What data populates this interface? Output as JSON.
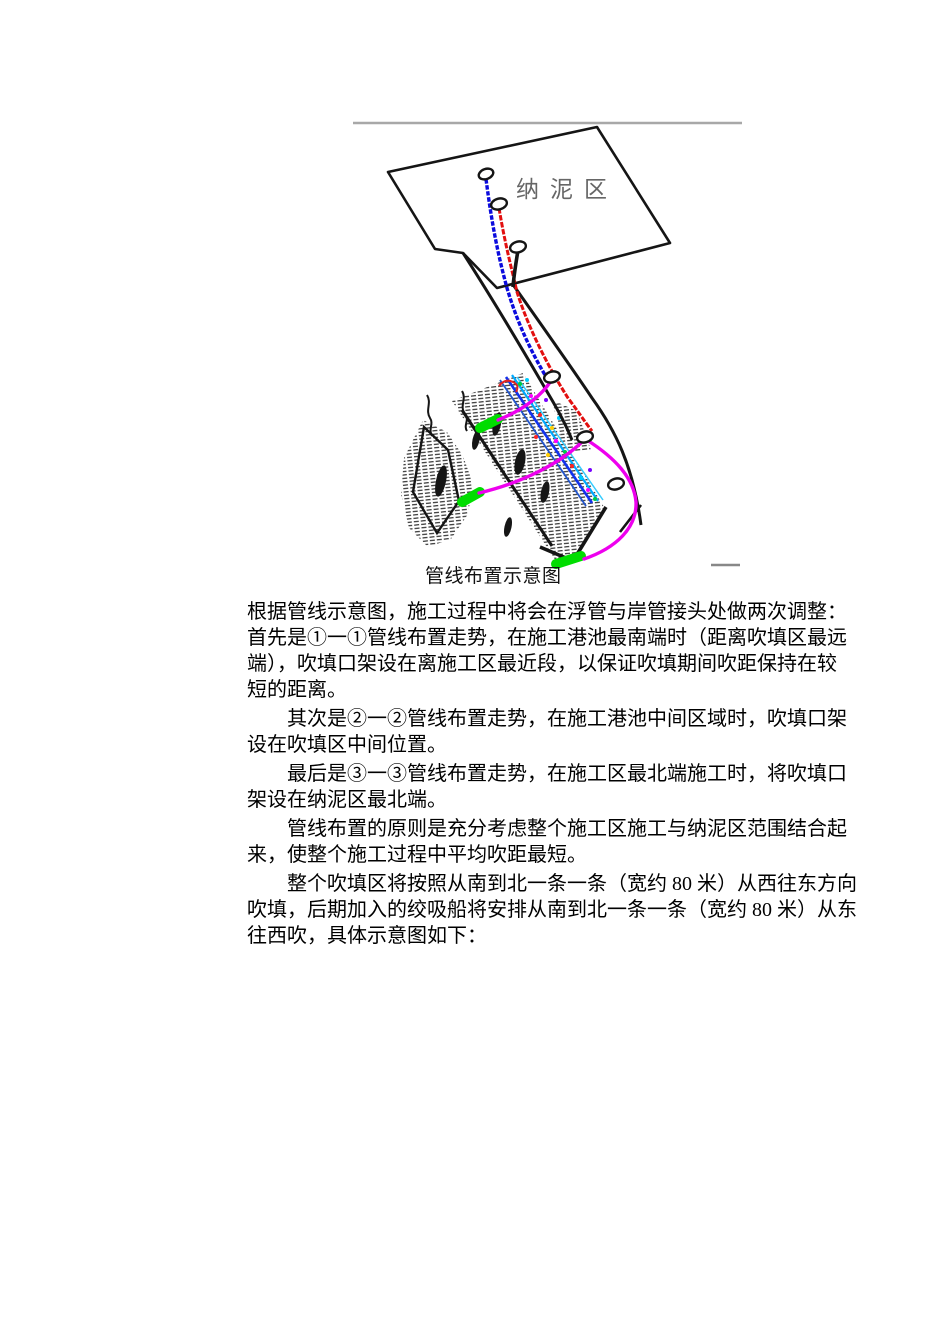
{
  "figure": {
    "region_label": "纳泥区",
    "caption": "管线布置示意图",
    "colors": {
      "ink": "#151515",
      "rule_gray": "#a8a8a8",
      "dash_gray": "#888888",
      "label_gray": "#666666",
      "pipe_blue": "#0b0bdd",
      "pipe_red": "#e20f0f",
      "arc_magenta": "#ee00ee",
      "marker_green": "#00dd00",
      "cluster_blue": "#1133ee",
      "cluster_cyan": "#00aaff",
      "cluster_light": "#33ccff"
    }
  },
  "body": {
    "paragraphs": [
      {
        "indent": false,
        "lines": [
          "根据管线示意图，施工过程中将会在浮管与岸管接头处做两次调整：",
          "首先是①一①管线布置走势，在施工港池最南端时（距离吹填区最远",
          "端），吹填口架设在离施工区最近段，以保证吹填期间吹距保持在较",
          "短的距离。"
        ]
      },
      {
        "indent": true,
        "lines": [
          "其次是②一②管线布置走势，在施工港池中间区域时，吹填口架",
          "设在吹填区中间位置。"
        ]
      },
      {
        "indent": true,
        "lines": [
          "最后是③一③管线布置走势，在施工区最北端施工时，将吹填口",
          "架设在纳泥区最北端。"
        ]
      },
      {
        "indent": true,
        "lines": [
          "管线布置的原则是充分考虑整个施工区施工与纳泥区范围结合起",
          "来，使整个施工过程中平均吹距最短。"
        ]
      },
      {
        "indent": true,
        "lines": [
          "整个吹填区将按照从南到北一条一条（宽约 80 米）从西往东方向",
          "吹填，后期加入的绞吸船将安排从南到北一条一条（宽约 80 米）从东",
          "往西吹，具体示意图如下："
        ]
      }
    ]
  }
}
